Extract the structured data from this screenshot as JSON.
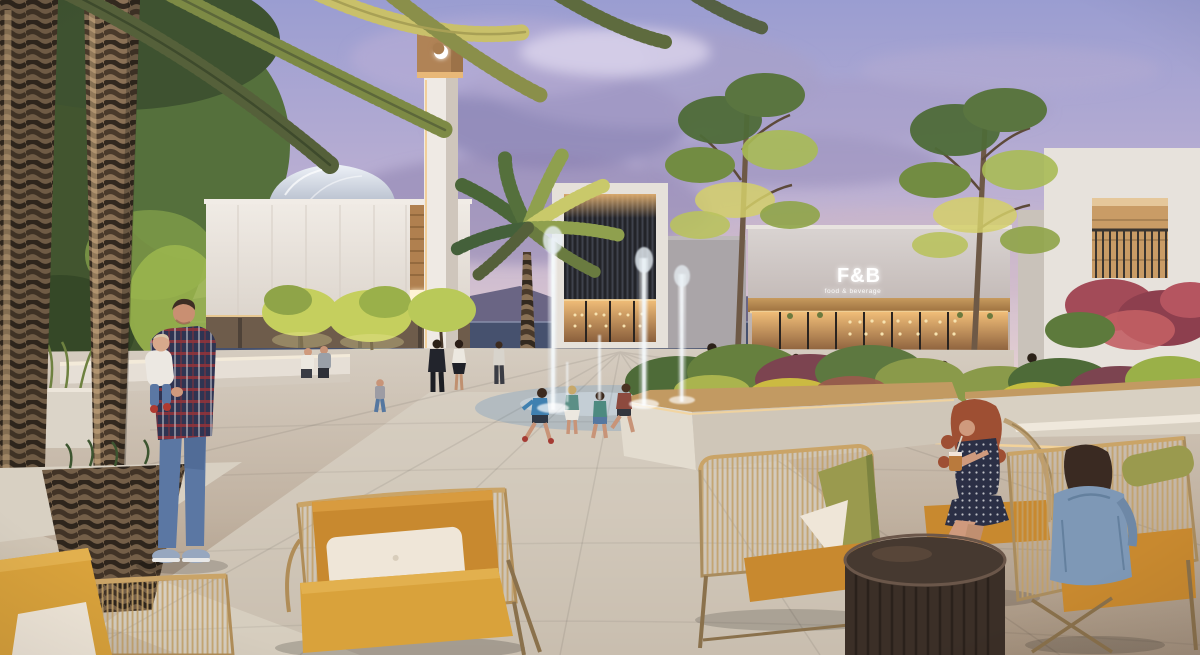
{
  "sign": {
    "main": "F&B",
    "sub": "food & beverage"
  },
  "palette": {
    "skyTop": "#9a9dd1",
    "skyMid": "#b9aed2",
    "skyHorizon": "#e8d3d3",
    "cloud": "#8b84b4",
    "seaDark": "#46516e",
    "mountain": "#6a6584",
    "wallWhite": "#eae5df",
    "wallShade": "#cfc7bf",
    "woodWarm": "#b0804f",
    "glowWarm": "#f2c98a",
    "windowGlow": "#fff3d6",
    "slatDark": "#25262b",
    "domeGlass": "#c5ccd8",
    "signWhite": "#ffffff",
    "palmGreen": "#5d7840",
    "palmLit": "#c9c06a",
    "treeGreen": "#4e6b38",
    "treeLit": "#a9bb55",
    "shrubMaroon": "#7c4450",
    "waterJet": "#e8f0f6",
    "paveLight": "#d8d0c3",
    "paveMid": "#c0b3a2",
    "paveDark": "#9d8b76",
    "planterWood": "#c29a62",
    "ledGlow": "#f5d49a",
    "cushionYellow": "#d9a23b",
    "cushionMustard": "#c8892f",
    "cushionOlive": "#9a9a4e",
    "pillowCream": "#efe6d8",
    "wickerTan": "#c2a068",
    "tableWood": "#463930",
    "denim": "#5b77a3",
    "skin": "#cf9a7d"
  }
}
